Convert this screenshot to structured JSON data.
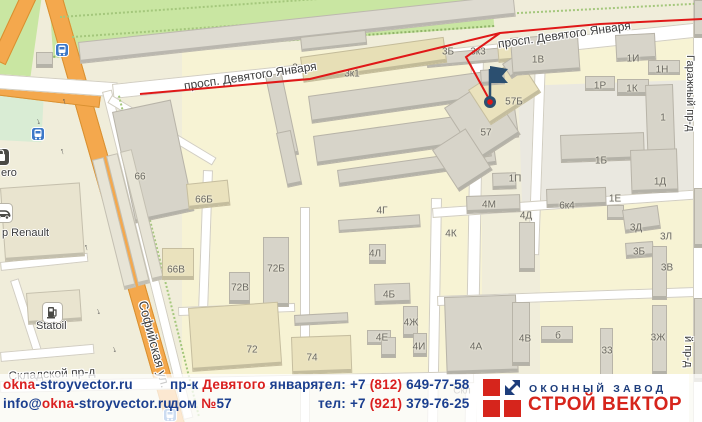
{
  "map": {
    "bg": "#f0edda",
    "zones": [
      [
        182,
        50,
        300,
        338,
        0,
        "#f7f3d4",
        ""
      ],
      [
        540,
        38,
        154,
        345,
        0,
        "#f7f3d4",
        ""
      ],
      [
        0,
        -8,
        42,
        95,
        8,
        "#c9e6a2",
        ""
      ],
      [
        48,
        -18,
        442,
        74,
        -4,
        "#c9e6a2",
        "park"
      ],
      [
        0,
        90,
        44,
        50,
        3,
        "#d9ecd4",
        ""
      ],
      [
        518,
        86,
        176,
        120,
        -2,
        "#eae8e0",
        ""
      ]
    ],
    "roads": [
      [
        42,
        -10,
        16,
        460,
        -16,
        "o"
      ],
      [
        30,
        -25,
        14,
        90,
        25,
        "o"
      ],
      [
        -5,
        80,
        105,
        13,
        7,
        "o"
      ],
      [
        -2,
        74,
        118,
        13,
        4,
        "w"
      ],
      [
        112,
        84,
        592,
        13,
        -6,
        "w"
      ],
      [
        102,
        92,
        8,
        336,
        -14,
        "w"
      ],
      [
        471,
        56,
        11,
        368,
        1,
        "w"
      ],
      [
        535,
        58,
        9,
        195,
        2,
        "w"
      ],
      [
        431,
        198,
        9,
        224,
        1,
        "w"
      ],
      [
        300,
        207,
        8,
        215,
        0,
        "w"
      ],
      [
        203,
        170,
        8,
        152,
        2,
        "w"
      ],
      [
        112,
        95,
        120,
        7,
        31,
        "w"
      ],
      [
        432,
        208,
        270,
        8,
        -4,
        "w"
      ],
      [
        437,
        296,
        265,
        8,
        -2,
        "w"
      ],
      [
        178,
        307,
        115,
        7,
        -2,
        "w"
      ],
      [
        0,
        381,
        472,
        10,
        -1.2,
        "w"
      ],
      [
        0,
        262,
        86,
        7,
        -6,
        "w"
      ],
      [
        10,
        281,
        7,
        78,
        -18,
        "w"
      ],
      [
        0,
        352,
        92,
        8,
        -5,
        "w"
      ],
      [
        693,
        0,
        8,
        422,
        0,
        "w"
      ]
    ],
    "deco": [
      [
        60,
        16,
        405,
        -4,
        "h"
      ],
      [
        72,
        36,
        398,
        -4,
        "h"
      ],
      [
        500,
        13,
        195,
        -3,
        "h"
      ],
      [
        118,
        96,
        330,
        -14,
        "v"
      ]
    ],
    "bcolors": {
      "g": "#d7d4c9",
      "l": "#dedbd1",
      "b": "#eae2bd",
      "t": "#e7dfb6",
      "p": "#e7e4d6",
      "c": "#e9e4cf"
    },
    "buildings": [
      [
        78,
        42,
        436,
        20,
        -6.2,
        "l"
      ],
      [
        300,
        37,
        64,
        13,
        -6.2,
        "g"
      ],
      [
        36,
        52,
        15,
        14,
        0,
        "g"
      ],
      [
        426,
        54,
        80,
        12,
        -5,
        "g"
      ],
      [
        497,
        44,
        16,
        17,
        -5,
        "b"
      ],
      [
        265,
        76,
        15,
        82,
        -12,
        "g"
      ],
      [
        276,
        133,
        13,
        54,
        -12,
        "g"
      ],
      [
        300,
        57,
        143,
        24,
        -8,
        "t"
      ],
      [
        308,
        96,
        178,
        26,
        -8,
        "g"
      ],
      [
        313,
        136,
        202,
        28,
        -8,
        "g"
      ],
      [
        337,
        170,
        157,
        15,
        -8,
        "g"
      ],
      [
        447,
        151,
        23,
        16,
        -8,
        "g"
      ],
      [
        472,
        144,
        16,
        13,
        -8,
        "g"
      ],
      [
        112,
        112,
        58,
        112,
        -12,
        "g"
      ],
      [
        92,
        160,
        10,
        132,
        -14,
        "p"
      ],
      [
        106,
        156,
        10,
        132,
        -14,
        "p"
      ],
      [
        120,
        152,
        10,
        132,
        -14,
        "p"
      ],
      [
        186,
        184,
        40,
        24,
        -6,
        "b"
      ],
      [
        162,
        248,
        30,
        30,
        0,
        "b"
      ],
      [
        263,
        237,
        24,
        68,
        0,
        "g"
      ],
      [
        229,
        272,
        19,
        30,
        0,
        "g"
      ],
      [
        188,
        308,
        88,
        62,
        -4,
        "b"
      ],
      [
        291,
        337,
        58,
        36,
        -2,
        "b"
      ],
      [
        294,
        315,
        52,
        9,
        -3,
        "g"
      ],
      [
        338,
        220,
        80,
        11,
        -4,
        "g"
      ],
      [
        369,
        244,
        15,
        18,
        0,
        "g"
      ],
      [
        374,
        284,
        34,
        19,
        -2,
        "g"
      ],
      [
        403,
        306,
        13,
        30,
        0,
        "g"
      ],
      [
        367,
        330,
        22,
        13,
        0,
        "g"
      ],
      [
        381,
        337,
        13,
        19,
        0,
        "g"
      ],
      [
        413,
        333,
        12,
        22,
        0,
        "g"
      ],
      [
        466,
        196,
        52,
        16,
        -2,
        "g"
      ],
      [
        546,
        189,
        58,
        17,
        -2,
        "g"
      ],
      [
        607,
        205,
        15,
        13,
        0,
        "g"
      ],
      [
        492,
        173,
        22,
        15,
        -2,
        "g"
      ],
      [
        519,
        222,
        14,
        48,
        0,
        "g"
      ],
      [
        444,
        108,
        48,
        62,
        -33,
        "g"
      ],
      [
        468,
        90,
        58,
        40,
        -33,
        "b"
      ],
      [
        502,
        64,
        28,
        16,
        -33,
        "g"
      ],
      [
        432,
        150,
        38,
        48,
        -33,
        "g"
      ],
      [
        510,
        38,
        66,
        36,
        -4,
        "g"
      ],
      [
        480,
        70,
        22,
        14,
        -4,
        "g"
      ],
      [
        615,
        35,
        38,
        25,
        -3,
        "g"
      ],
      [
        648,
        60,
        30,
        13,
        0,
        "g"
      ],
      [
        585,
        76,
        28,
        13,
        0,
        "g"
      ],
      [
        617,
        79,
        30,
        15,
        0,
        "g"
      ],
      [
        645,
        85,
        26,
        78,
        -2,
        "g"
      ],
      [
        560,
        135,
        82,
        26,
        -2,
        "g"
      ],
      [
        630,
        150,
        45,
        42,
        -2,
        "g"
      ],
      [
        622,
        210,
        34,
        22,
        -8,
        "g"
      ],
      [
        625,
        243,
        26,
        14,
        -4,
        "g"
      ],
      [
        652,
        246,
        13,
        52,
        0,
        "g"
      ],
      [
        652,
        305,
        13,
        68,
        0,
        "g"
      ],
      [
        600,
        328,
        11,
        50,
        0,
        "g"
      ],
      [
        444,
        297,
        70,
        76,
        -2,
        "g"
      ],
      [
        512,
        302,
        16,
        62,
        0,
        "g"
      ],
      [
        541,
        326,
        30,
        15,
        0,
        "g"
      ],
      [
        694,
        0,
        8,
        36,
        0,
        "g"
      ],
      [
        694,
        188,
        8,
        58,
        0,
        "g"
      ],
      [
        694,
        298,
        8,
        82,
        0,
        "g"
      ],
      [
        0,
        188,
        78,
        72,
        -4,
        "c"
      ],
      [
        26,
        293,
        52,
        30,
        -4,
        "c"
      ]
    ],
    "labels": [
      [
        "3Б",
        448,
        52
      ],
      [
        "3к3",
        478,
        52
      ],
      [
        "3",
        295,
        68
      ],
      [
        "3к1",
        352,
        74
      ],
      [
        "1В",
        538,
        60
      ],
      [
        "1И",
        633,
        59
      ],
      [
        "1Н",
        662,
        70
      ],
      [
        "1Р",
        600,
        86
      ],
      [
        "1К",
        632,
        89
      ],
      [
        "57Б",
        514,
        102
      ],
      [
        "57",
        486,
        133
      ],
      [
        "1",
        663,
        118
      ],
      [
        "1Б",
        601,
        161
      ],
      [
        "1П",
        515,
        179
      ],
      [
        "1Д",
        660,
        182
      ],
      [
        "1Е",
        615,
        199
      ],
      [
        "4М",
        489,
        205
      ],
      [
        "6к4",
        567,
        206
      ],
      [
        "4Г",
        382,
        211
      ],
      [
        "4Д",
        526,
        216
      ],
      [
        "4К",
        451,
        234
      ],
      [
        "3Д",
        636,
        228
      ],
      [
        "3Л",
        666,
        237
      ],
      [
        "4Л",
        375,
        254
      ],
      [
        "3Б",
        639,
        252
      ],
      [
        "3В",
        667,
        268
      ],
      [
        "72Б",
        276,
        269
      ],
      [
        "72В",
        240,
        288
      ],
      [
        "66",
        140,
        177
      ],
      [
        "66Б",
        204,
        200
      ],
      [
        "66В",
        176,
        270
      ],
      [
        "4Б",
        389,
        295
      ],
      [
        "4Ж",
        411,
        323
      ],
      [
        "4Е",
        382,
        338
      ],
      [
        "4И",
        419,
        347
      ],
      [
        "4В",
        525,
        339
      ],
      [
        "б",
        558,
        336
      ],
      [
        "4А",
        476,
        347
      ],
      [
        "33",
        607,
        351
      ],
      [
        "3Ж",
        658,
        338
      ],
      [
        "72",
        252,
        350
      ],
      [
        "74",
        312,
        358
      ],
      [
        "Скл",
        462,
        391
      ]
    ],
    "streets": [
      [
        "просп. Девятого Января",
        183,
        79,
        -8.6,
        12
      ],
      [
        "просп. Девятого Января",
        497,
        37,
        -8,
        12
      ],
      [
        "Софийская ул.",
        150,
        299,
        75,
        13
      ],
      [
        "Складской пр-д",
        8,
        369,
        -3,
        12
      ],
      [
        "Гаражный пр-д",
        696,
        55,
        90,
        11
      ],
      [
        "й пр-д",
        694,
        336,
        90,
        11
      ]
    ],
    "arrows": [
      [
        36,
        116,
        "↓"
      ],
      [
        62,
        96,
        "↑"
      ],
      [
        60,
        146,
        "↑"
      ],
      [
        84,
        242,
        "↑"
      ],
      [
        96,
        306,
        "↓"
      ],
      [
        112,
        344,
        "↓"
      ]
    ],
    "pois": [
      {
        "t": "transit",
        "x": 55,
        "y": 43,
        "label": "",
        "lx": 0,
        "ly": 0
      },
      {
        "t": "transit",
        "x": 31,
        "y": 127,
        "label": "",
        "lx": 0,
        "ly": 0
      },
      {
        "t": "transit",
        "x": 163,
        "y": 408,
        "label": "",
        "lx": 0,
        "ly": 0
      },
      {
        "t": "shop",
        "x": -8,
        "y": 148,
        "label": "ero",
        "lx": 1,
        "ly": 167
      },
      {
        "t": "car",
        "x": -7,
        "y": 203,
        "label": "р Renault",
        "lx": 2,
        "ly": 227
      },
      {
        "t": "fuel",
        "x": 42,
        "y": 302,
        "label": "Statoil",
        "lx": 36,
        "ly": 320
      }
    ],
    "route": {
      "color": "#e01818",
      "width": 2,
      "main": "140,94 310,79 500,33 600,24 702,19",
      "branch": "500,33 466,57 489,99",
      "marker": [
        490,
        102
      ],
      "marker_ring": "#2b4f70",
      "marker_dot": "#e01818",
      "pole": [
        490,
        100,
        490,
        69
      ],
      "flag": "490,66 508,69 502,76 508,83 490,83",
      "flag_color": "#2b4f70"
    }
  },
  "footer": {
    "colors": {
      "b": "#1b3f8f",
      "r": "#da1f1f"
    },
    "rows": [
      {
        "y": 3,
        "cells": [
          {
            "name": "website-link",
            "inter": true,
            "x": 3,
            "segs": [
              [
                "okna",
                "r"
              ],
              [
                "-stroyvector.ru",
                "b"
              ]
            ]
          },
          {
            "name": "address-line1",
            "inter": false,
            "x": 170,
            "segs": [
              [
                "пр-к ",
                "b"
              ],
              [
                "Девятого",
                "r"
              ],
              [
                " января,",
                "b"
              ]
            ]
          },
          {
            "name": "phone-line1",
            "inter": false,
            "x": 318,
            "segs": [
              [
                "тел: +7 ",
                "b"
              ],
              [
                "(812)",
                "r"
              ],
              [
                " 649-77-58",
                "b"
              ]
            ]
          }
        ]
      },
      {
        "y": 22,
        "cells": [
          {
            "name": "email-link",
            "inter": true,
            "x": 3,
            "segs": [
              [
                "info@",
                "b"
              ],
              [
                "okna",
                "r"
              ],
              [
                "-stroyvector.ru",
                "b"
              ]
            ]
          },
          {
            "name": "address-line2",
            "inter": false,
            "x": 170,
            "segs": [
              [
                "дом ",
                "b"
              ],
              [
                "№",
                "r"
              ],
              [
                "57",
                "b"
              ]
            ]
          },
          {
            "name": "phone-line2",
            "inter": false,
            "x": 318,
            "segs": [
              [
                "тел: +7 ",
                "b"
              ],
              [
                "(921)",
                "r"
              ],
              [
                " 379-76-25",
                "b"
              ]
            ]
          }
        ]
      }
    ],
    "logo": {
      "line1": "ОКОННЫЙ ЗАВОД",
      "line2": "СТРОЙ ВЕКТОР"
    }
  }
}
